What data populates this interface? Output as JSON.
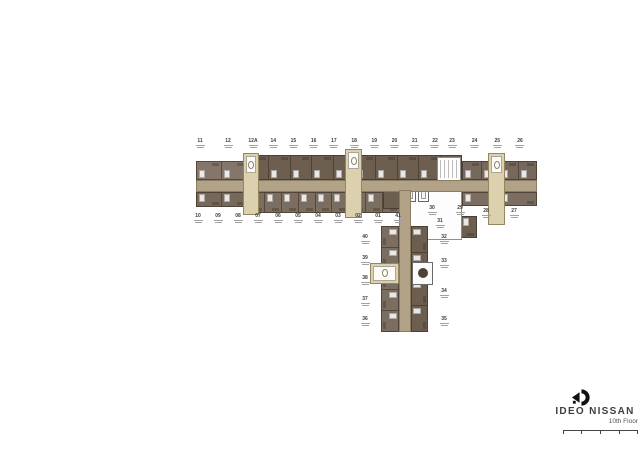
{
  "page": {
    "background": "#ffffff"
  },
  "plan": {
    "colors": {
      "unit_dark": "#6d5f50",
      "unit_mid": "#7b6d5f",
      "unit_mid2": "#76685b",
      "unit_light": "#84766a",
      "corridor": "#b2a287",
      "cream": "#dcd1af"
    },
    "labels": {
      "top_left": [
        "11",
        "12"
      ],
      "top_mid": [
        "12A",
        "14",
        "15",
        "16",
        "17",
        "18",
        "19",
        "20",
        "21",
        "22"
      ],
      "top_right": [
        "23",
        "24",
        "25",
        "26"
      ],
      "bottom_left": [
        "10",
        "09",
        "08",
        "07",
        "06",
        "05",
        "04",
        "03",
        "02",
        "01",
        "41"
      ],
      "core_a": [
        "30",
        "29"
      ],
      "core_b": [
        "31"
      ],
      "bottom_right": [
        "28",
        "27"
      ],
      "wing_left": [
        "40",
        "39",
        "38",
        "37",
        "36"
      ],
      "wing_right_upper": [
        "32",
        "33"
      ],
      "wing_right_lower": [
        "34",
        "35"
      ]
    },
    "cells": {
      "top_left": 2,
      "top_mid": 10,
      "top_right": 4,
      "bottom_left": 2,
      "bottom_mid": 9,
      "bottom_right": 2,
      "junction": 2,
      "wing_left": 5,
      "wing_right": 4
    }
  },
  "footer": {
    "brand": "IDEO NISSAN",
    "floor": "10th Floor"
  }
}
